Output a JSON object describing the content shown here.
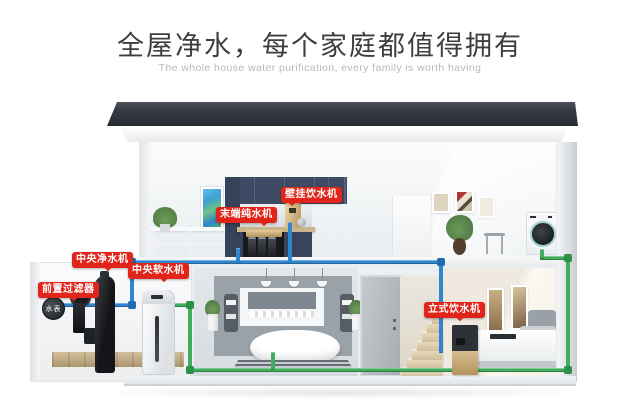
{
  "header": {
    "title": "全屋净水，每个家庭都值得拥有",
    "subtitle": "The whole house water purification, every family is worth having"
  },
  "device_labels": {
    "wall_dispenser": "壁挂饮水机",
    "terminal_purifier": "末端纯水机",
    "central_purifier": "中央净水机",
    "central_softener": "中央软水机",
    "pre_filter": "前置过滤器",
    "water_meter": "水表",
    "standing_dispenser": "立式饮水机"
  },
  "colors": {
    "label_red": "#e1251b",
    "pipe_blue": "#2f86cf",
    "pipe_green": "#3fae5a",
    "roof_dark": "#343943",
    "cabinet_blue": "#3e4a63"
  }
}
